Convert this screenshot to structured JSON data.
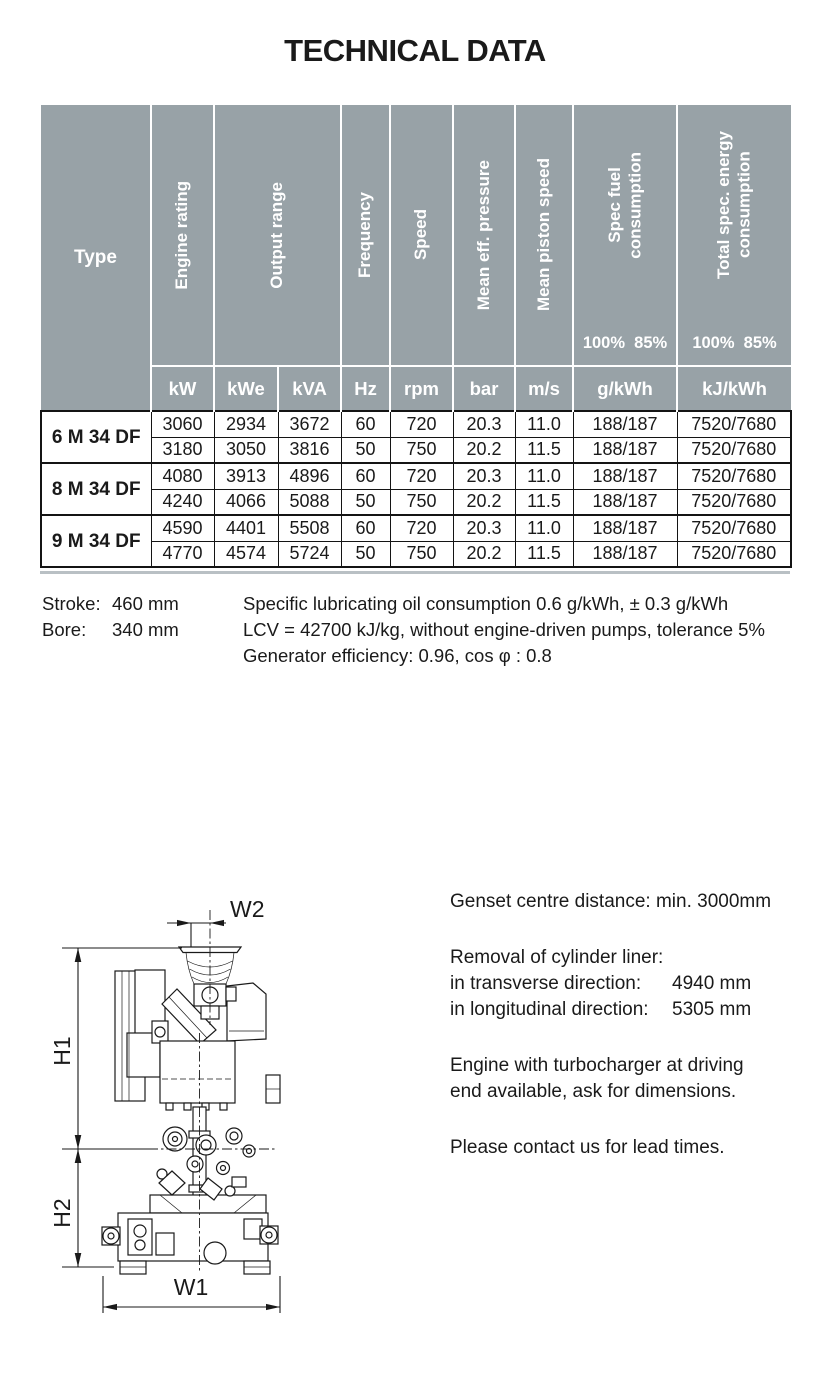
{
  "title": "TECHNICAL DATA",
  "colors": {
    "header_bg": "#98a2a7",
    "header_text": "#ffffff",
    "body_text": "#1a1a1a",
    "table_rule": "#141414",
    "bottom_rule": "#b9c0c4"
  },
  "table": {
    "headers": {
      "type": "Type",
      "engine_rating": "Engine rating",
      "output_range": "Output range",
      "frequency": "Frequency",
      "speed": "Speed",
      "mean_eff_pressure": "Mean eff. pressure",
      "mean_piston_speed": "Mean piston speed",
      "spec_fuel_line1": "Spec fuel",
      "spec_fuel_line2": "consumption",
      "total_line1": "Total spec. energy",
      "total_line2": "consumption",
      "load_points": "100%  85%"
    },
    "units": [
      "kW",
      "kWe",
      "kVA",
      "Hz",
      "rpm",
      "bar",
      "m/s",
      "g/kWh",
      "kJ/kWh"
    ],
    "rows": [
      {
        "type": "6 M 34 DF",
        "data": [
          [
            "3060",
            "2934",
            "3672",
            "60",
            "720",
            "20.3",
            "11.0",
            "188/187",
            "7520/7680"
          ],
          [
            "3180",
            "3050",
            "3816",
            "50",
            "750",
            "20.2",
            "11.5",
            "188/187",
            "7520/7680"
          ]
        ]
      },
      {
        "type": "8 M 34 DF",
        "data": [
          [
            "4080",
            "3913",
            "4896",
            "60",
            "720",
            "20.3",
            "11.0",
            "188/187",
            "7520/7680"
          ],
          [
            "4240",
            "4066",
            "5088",
            "50",
            "750",
            "20.2",
            "11.5",
            "188/187",
            "7520/7680"
          ]
        ]
      },
      {
        "type": "9 M 34 DF",
        "data": [
          [
            "4590",
            "4401",
            "5508",
            "60",
            "720",
            "20.3",
            "11.0",
            "188/187",
            "7520/7680"
          ],
          [
            "4770",
            "4574",
            "5724",
            "50",
            "750",
            "20.2",
            "11.5",
            "188/187",
            "7520/7680"
          ]
        ]
      }
    ]
  },
  "notes": {
    "stroke_label": "Stroke:",
    "stroke_value": "460 mm",
    "bore_label": "Bore:",
    "bore_value": "340 mm",
    "line1": "Specific lubricating oil consumption 0.6 g/kWh, ± 0.3 g/kWh",
    "line2": "LCV = 42700 kJ/kg, without engine-driven pumps, tolerance 5%",
    "line3": "Generator efficiency: 0.96, cos φ : 0.8"
  },
  "info": {
    "genset": "Genset centre distance: min. 3000mm",
    "removal_title": "Removal of cylinder liner:",
    "transverse_label": "in transverse direction:",
    "transverse_value": "4940 mm",
    "longitudinal_label": "in longitudinal direction:",
    "longitudinal_value": "5305 mm",
    "turbo1": "Engine with turbocharger at driving",
    "turbo2": "end available, ask for dimensions.",
    "contact": "Please contact us for lead times."
  },
  "drawing": {
    "labels": {
      "w1": "W1",
      "w2": "W2",
      "h1": "H1",
      "h2": "H2"
    }
  }
}
